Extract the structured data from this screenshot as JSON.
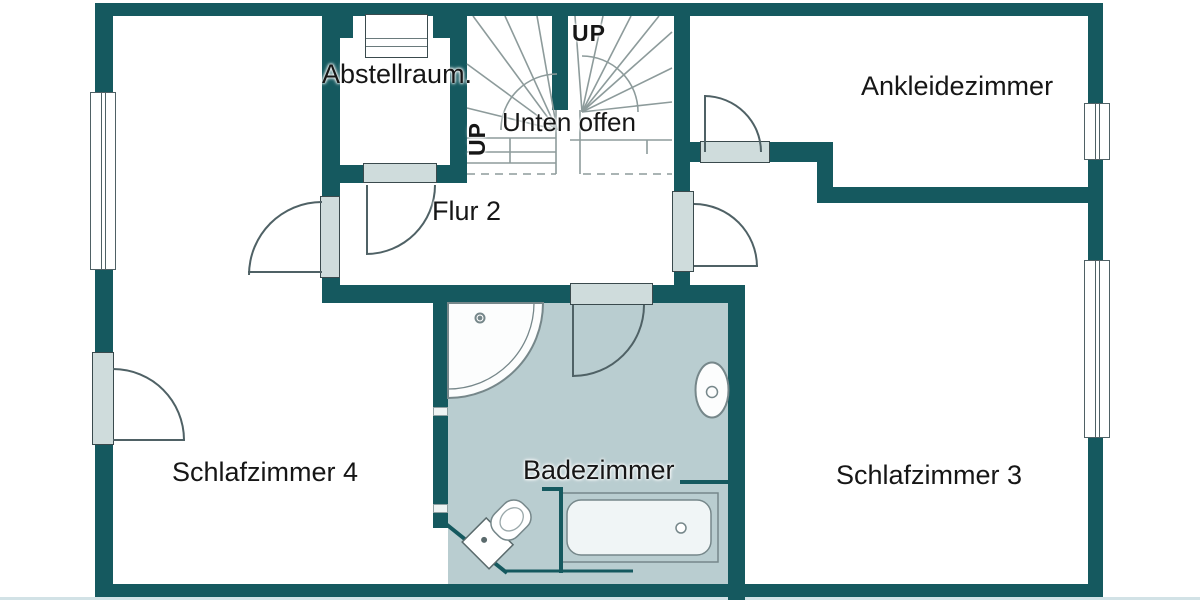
{
  "plan": {
    "type": "floor-plan",
    "floor_annotation": "Unten offen",
    "stair_direction_labels": [
      "UP",
      "UP"
    ]
  },
  "labels": {
    "abstellraum": "Abstellraum.",
    "ankleidezimmer": "Ankleidezimmer",
    "unten_offen": "Unten offen",
    "up_left": "UP",
    "up_right": "UP",
    "flur": "Flur 2",
    "schlafzimmer4": "Schlafzimmer 4",
    "badezimmer": "Badezimmer",
    "schlafzimmer3": "Schlafzimmer 3"
  },
  "rooms": [
    {
      "name": "Abstellraum."
    },
    {
      "name": "Ankleidezimmer"
    },
    {
      "name": "Flur 2"
    },
    {
      "name": "Schlafzimmer 4"
    },
    {
      "name": "Badezimmer"
    },
    {
      "name": "Schlafzimmer 3"
    }
  ],
  "colors": {
    "wall": "#15595f",
    "bath_floor": "#b9cdd0",
    "door_panel": "#cfdcdc",
    "outline": "#4f6165",
    "stair_line": "#8d9b9b",
    "text": "#161616",
    "background": "#ffffff",
    "fixture_fill": "#fcfdfd",
    "bottom_edge": "#d2e2e6"
  }
}
